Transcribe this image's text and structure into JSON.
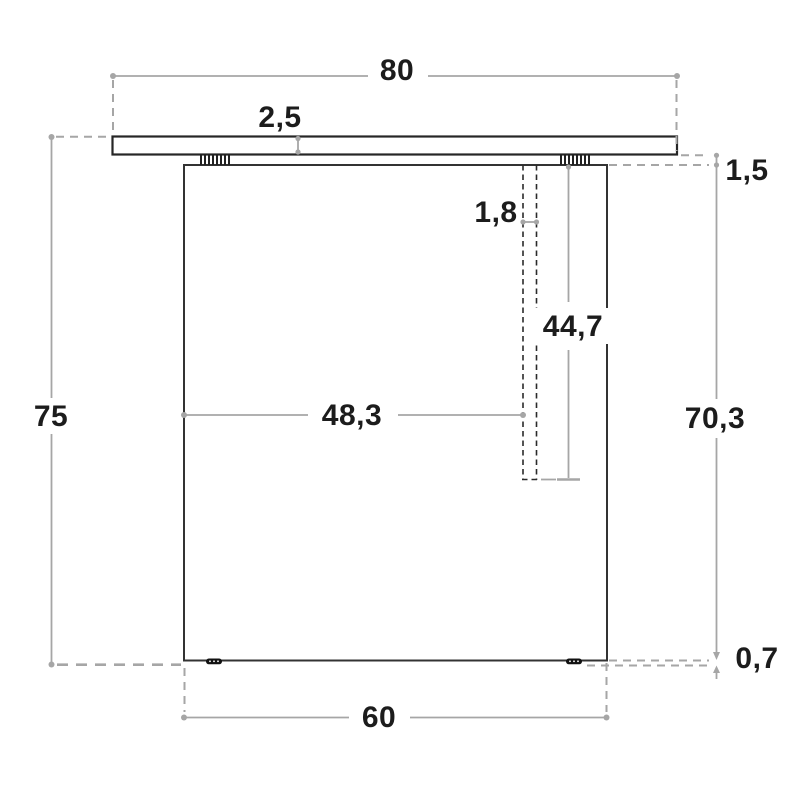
{
  "drawing": {
    "type": "technical-drawing",
    "subject": "table frame front elevation with dimension lines",
    "colors": {
      "outline": "#333333",
      "dimension": "#a6a6a6",
      "label": "#1c1c1c",
      "background": "#ffffff"
    },
    "labels": {
      "top_width": "80",
      "top_thickness": "2,5",
      "top_to_panel_gap": "1,5",
      "slot_width": "1,8",
      "slot_depth": "44,7",
      "slot_offset_from_left": "48,3",
      "overall_height": "75",
      "panel_height": "70,3",
      "foot_height": "0,7",
      "base_width": "60"
    }
  }
}
